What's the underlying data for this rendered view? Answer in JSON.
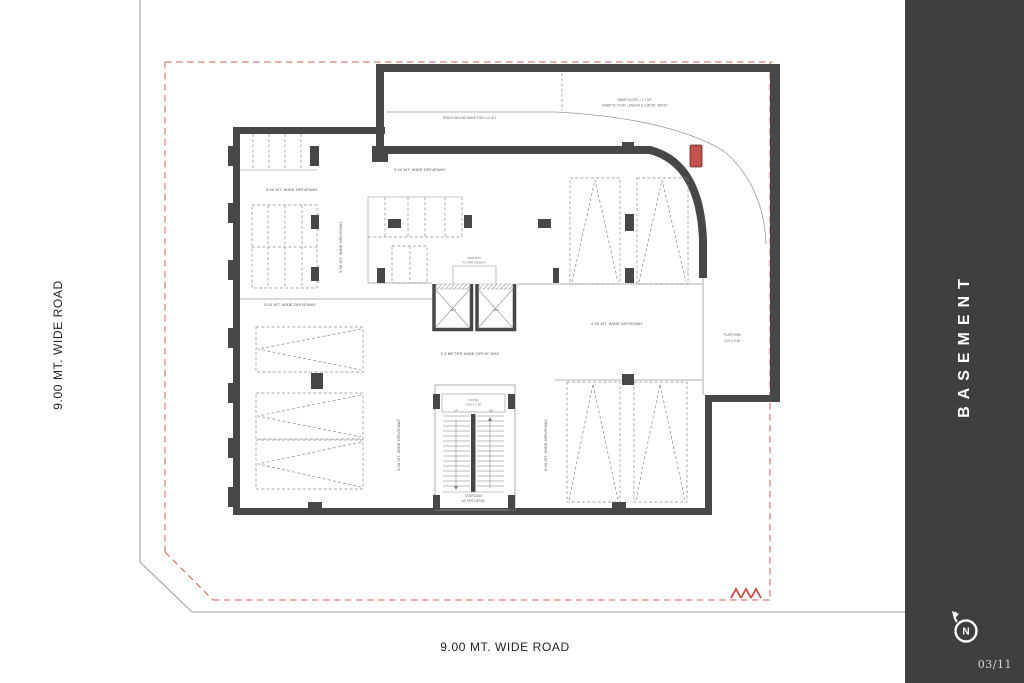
{
  "sidebar": {
    "title": "BASEMENT",
    "page_number": "03/11",
    "north_label": "N",
    "background": "#3f3f3f"
  },
  "roads": {
    "left": "9.00 MT. WIDE ROAD",
    "bottom": "9.00 MT. WIDE ROAD"
  },
  "plan": {
    "ramp": {
      "note_line1": "RAMP SLOPE = 1:7 MT.",
      "note_line2": "RAMP 51.70 MT. LENGTH & 3.25 MT. WIDTH",
      "space_below": "SPACE BELOW RAMP FOR U.G.W.T."
    },
    "driveways": {
      "d300": "3.00 MT. WIDE DRIVEWAY",
      "d450": "4.50 MT. WIDE DRIVEWAY",
      "d340": "3.4 METER WIDE DRIVE WAY"
    },
    "lift": {
      "label": "LIFT",
      "opening_line1": "OPENING",
      "opening_line2": "AS PER DESIGN"
    },
    "stair": {
      "foyer_line1": "FOYER",
      "foyer_line2": "3.00 X 2.00",
      "up": "UP",
      "dn": "DN",
      "label_line1": "STAIRCASE",
      "label_line2": "AS PER DETAIL"
    },
    "platform": {
      "line1": "PLATFORM",
      "line2": "3.20 X 6.00"
    },
    "colors": {
      "wall": "#474747",
      "boundary_red": "#d05c52",
      "car_red": "#c4524c"
    }
  }
}
